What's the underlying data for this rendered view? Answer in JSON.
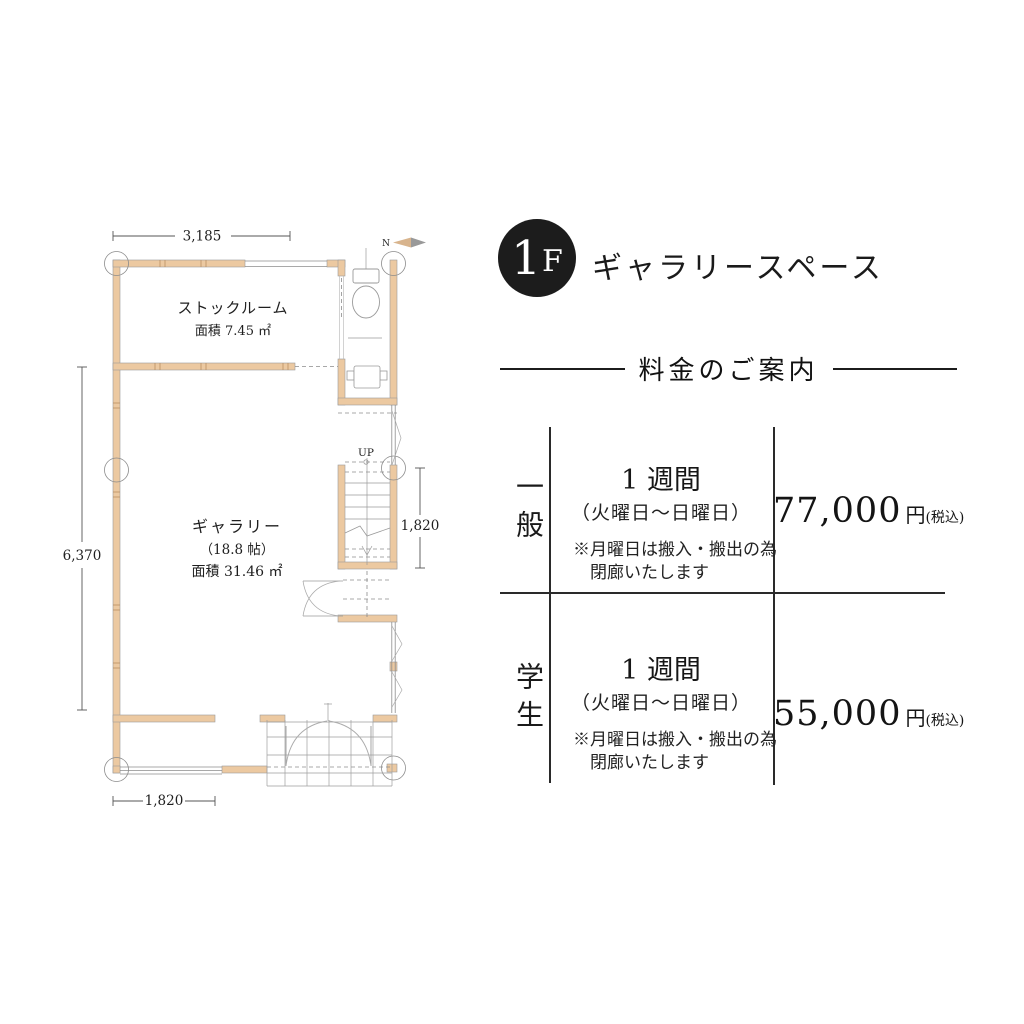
{
  "header": {
    "floor_number": "1",
    "floor_letter": "F",
    "title": "ギャラリースペース"
  },
  "pricing": {
    "section_title": "料金のご案内",
    "rows": [
      {
        "category": "一般",
        "duration": "1 週間",
        "period": "（火曜日〜日曜日）",
        "note1": "※月曜日は搬入・搬出の為",
        "note2": "閉廊いたします",
        "price": "77,000",
        "yen": "円",
        "tax": "(税込)"
      },
      {
        "category": "学生",
        "duration": "1 週間",
        "period": "（火曜日〜日曜日）",
        "note1": "※月曜日は搬入・搬出の為",
        "note2": "閉廊いたします",
        "price": "55,000",
        "yen": "円",
        "tax": "(税込)"
      }
    ]
  },
  "floor_plan": {
    "stock_room": {
      "name": "ストックルーム",
      "area": "面積 7.45 ㎡"
    },
    "gallery": {
      "name": "ギャラリー",
      "size": "（18.8 帖）",
      "area": "面積 31.46 ㎡"
    },
    "up_label": "UP",
    "north_label": "N",
    "dim_top": "3,185",
    "dim_left": "6,370",
    "dim_stairs": "1,820",
    "dim_bottom": "1,820",
    "colors": {
      "wall": "#ecc9a1",
      "line": "#8c8c8c",
      "accent": "#1c1c1c"
    }
  }
}
